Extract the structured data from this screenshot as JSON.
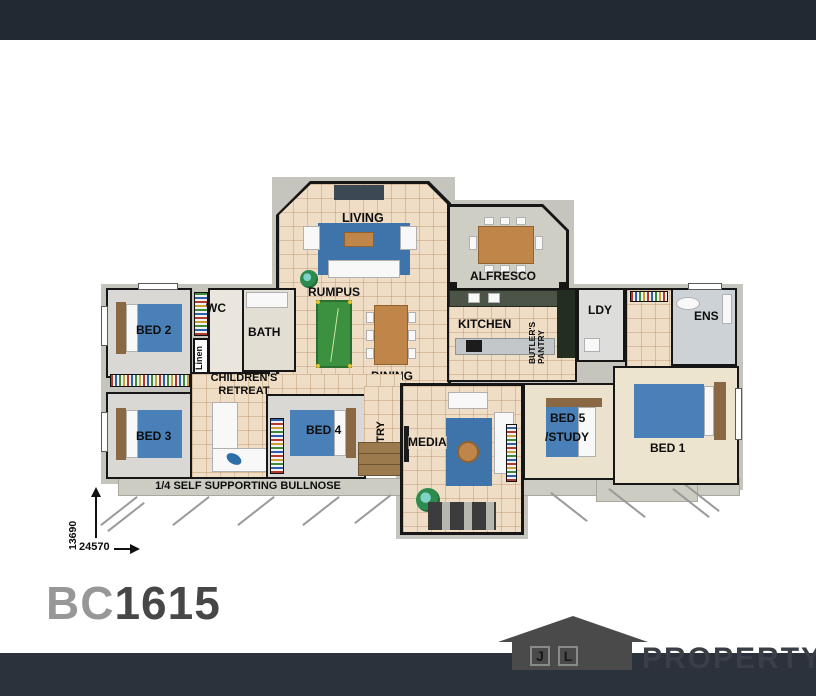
{
  "plan": {
    "code_prefix": "BC",
    "code_suffix": "1615"
  },
  "rooms": {
    "living": "LIVING",
    "rumpus": "RUMPUS",
    "alfresco": "ALFRESCO",
    "kitchen": "KITCHEN",
    "butlers_line1": "BUTLER'S",
    "butlers_line2": "PANTRY",
    "ldy": "LDY",
    "ens": "ENS",
    "wc": "WC",
    "bath": "BATH",
    "bed2": "BED 2",
    "bed3": "BED 3",
    "bed4": "BED 4",
    "bed5_line1": "BED 5",
    "bed5_line2": "/STUDY",
    "bed1": "BED 1",
    "dining": "DINING",
    "entry": "ENTRY",
    "media": "MEDIA",
    "retreat_line1": "CHILDREN'S",
    "retreat_line2": "RETREAT",
    "linen_robe": "Linen",
    "linen_hall": "Linen"
  },
  "labels": {
    "bullnose": "1/4 SELF SUPPORTING BULLNOSE"
  },
  "dimensions": {
    "depth": "13690",
    "width": "24570"
  },
  "brand": {
    "initial_j": "J",
    "initial_l": "L",
    "name": "PROPERTY"
  }
}
